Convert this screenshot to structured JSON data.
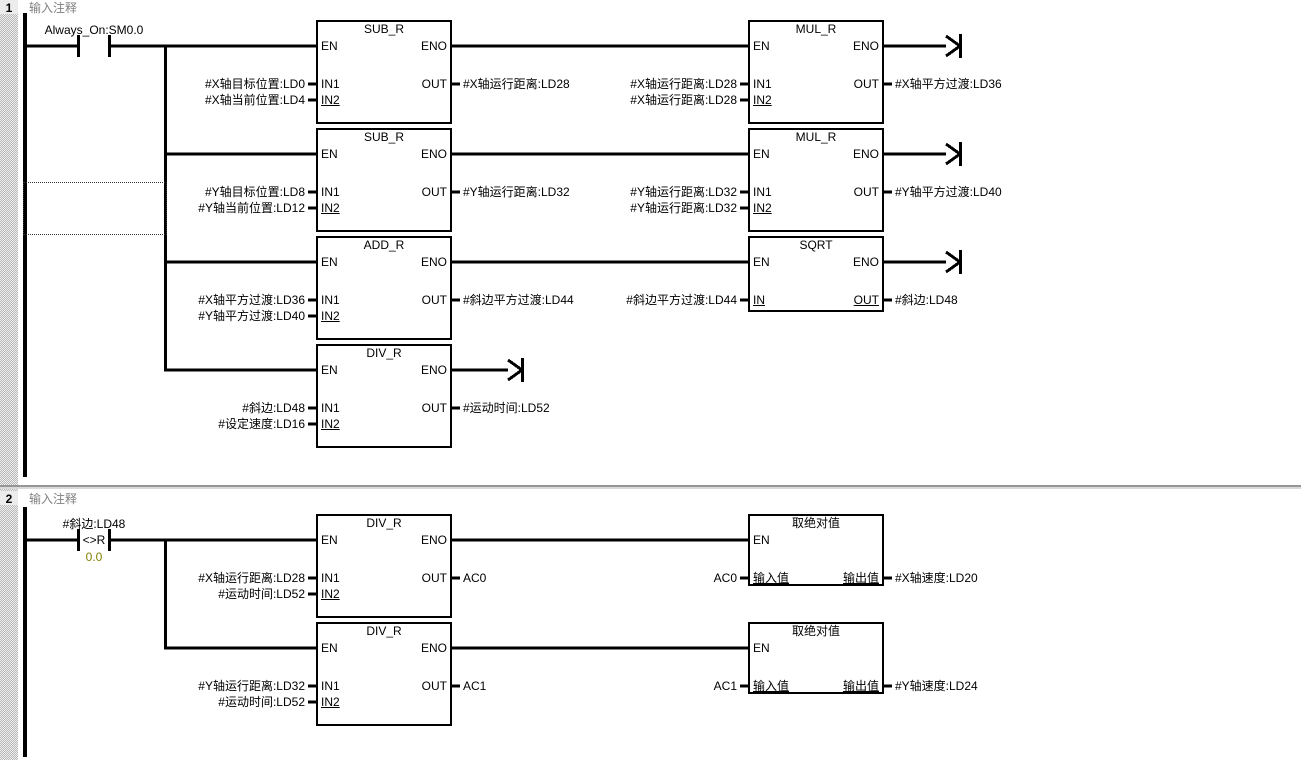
{
  "colors": {
    "wire": "#000000",
    "comment_text": "#808080",
    "compare_value_text": "#808000",
    "canvas": "#ffffff",
    "gutter": "#d9d9d9"
  },
  "diagram": {
    "networks": [
      {
        "number": "1",
        "comment": "输入注释",
        "contact": {
          "type": "normally-open",
          "label": "Always_On:SM0.0"
        },
        "rows": [
          {
            "blocks": [
              {
                "col": 0,
                "kind": "fb2",
                "title": "SUB_R",
                "en": "EN",
                "eno": "ENO",
                "inputs": [
                  {
                    "port": "IN1",
                    "label": "#X轴目标位置:LD0"
                  },
                  {
                    "port": "IN2",
                    "label": "#X轴当前位置:LD4"
                  }
                ],
                "output": {
                  "port": "OUT",
                  "label": "#X轴运行距离:LD28"
                }
              },
              {
                "col": 1,
                "kind": "fb2",
                "title": "MUL_R",
                "en": "EN",
                "eno": "ENO",
                "inputs": [
                  {
                    "port": "IN1",
                    "label": "#X轴运行距离:LD28"
                  },
                  {
                    "port": "IN2",
                    "label": "#X轴运行距离:LD28"
                  }
                ],
                "output": {
                  "port": "OUT",
                  "label": "#X轴平方过渡:LD36"
                },
                "arrow": "long"
              }
            ]
          },
          {
            "blocks": [
              {
                "col": 0,
                "kind": "fb2",
                "title": "SUB_R",
                "en": "EN",
                "eno": "ENO",
                "inputs": [
                  {
                    "port": "IN1",
                    "label": "#Y轴目标位置:LD8"
                  },
                  {
                    "port": "IN2",
                    "label": "#Y轴当前位置:LD12"
                  }
                ],
                "output": {
                  "port": "OUT",
                  "label": "#Y轴运行距离:LD32"
                }
              },
              {
                "col": 1,
                "kind": "fb2",
                "title": "MUL_R",
                "en": "EN",
                "eno": "ENO",
                "inputs": [
                  {
                    "port": "IN1",
                    "label": "#Y轴运行距离:LD32"
                  },
                  {
                    "port": "IN2",
                    "label": "#Y轴运行距离:LD32"
                  }
                ],
                "output": {
                  "port": "OUT",
                  "label": "#Y轴平方过渡:LD40"
                },
                "arrow": "long"
              }
            ]
          },
          {
            "blocks": [
              {
                "col": 0,
                "kind": "fb2",
                "title": "ADD_R",
                "en": "EN",
                "eno": "ENO",
                "inputs": [
                  {
                    "port": "IN1",
                    "label": "#X轴平方过渡:LD36"
                  },
                  {
                    "port": "IN2",
                    "label": "#Y轴平方过渡:LD40"
                  }
                ],
                "output": {
                  "port": "OUT",
                  "label": "#斜边平方过渡:LD44"
                }
              },
              {
                "col": 1,
                "kind": "fb1",
                "title": "SQRT",
                "en": "EN",
                "eno": "ENO",
                "input": {
                  "port": "IN",
                  "label": "#斜边平方过渡:LD44"
                },
                "output": {
                  "port": "OUT",
                  "label": "#斜边:LD48"
                },
                "arrow": "long"
              }
            ]
          },
          {
            "blocks": [
              {
                "col": 0,
                "kind": "fb2",
                "title": "DIV_R",
                "en": "EN",
                "eno": "ENO",
                "inputs": [
                  {
                    "port": "IN1",
                    "label": "#斜边:LD48"
                  },
                  {
                    "port": "IN2",
                    "label": "#设定速度:LD16"
                  }
                ],
                "output": {
                  "port": "OUT",
                  "label": "#运动时间:LD52"
                },
                "arrow": "short"
              }
            ]
          }
        ]
      },
      {
        "number": "2",
        "comment": "输入注释",
        "contact": {
          "type": "compare",
          "label": "#斜边:LD48",
          "operator": "<>R",
          "value": "0.0"
        },
        "rows": [
          {
            "blocks": [
              {
                "col": 0,
                "kind": "fb2",
                "title": "DIV_R",
                "en": "EN",
                "eno": "ENO",
                "inputs": [
                  {
                    "port": "IN1",
                    "label": "#X轴运行距离:LD28"
                  },
                  {
                    "port": "IN2",
                    "label": "#运动时间:LD52"
                  }
                ],
                "output": {
                  "port": "OUT",
                  "label": "AC0"
                }
              },
              {
                "col": 1,
                "kind": "sub",
                "title": "取绝对值",
                "en": "EN",
                "input": {
                  "port": "输入值",
                  "label": "AC0"
                },
                "output": {
                  "port": "输出值",
                  "label": "#X轴速度:LD20"
                }
              }
            ]
          },
          {
            "blocks": [
              {
                "col": 0,
                "kind": "fb2",
                "title": "DIV_R",
                "en": "EN",
                "eno": "ENO",
                "inputs": [
                  {
                    "port": "IN1",
                    "label": "#Y轴运行距离:LD32"
                  },
                  {
                    "port": "IN2",
                    "label": "#运动时间:LD52"
                  }
                ],
                "output": {
                  "port": "OUT",
                  "label": "AC1"
                }
              },
              {
                "col": 1,
                "kind": "sub",
                "title": "取绝对值",
                "en": "EN",
                "input": {
                  "port": "输入值",
                  "label": "AC1"
                },
                "output": {
                  "port": "输出值",
                  "label": "#Y轴速度:LD24"
                }
              }
            ]
          }
        ]
      }
    ]
  }
}
